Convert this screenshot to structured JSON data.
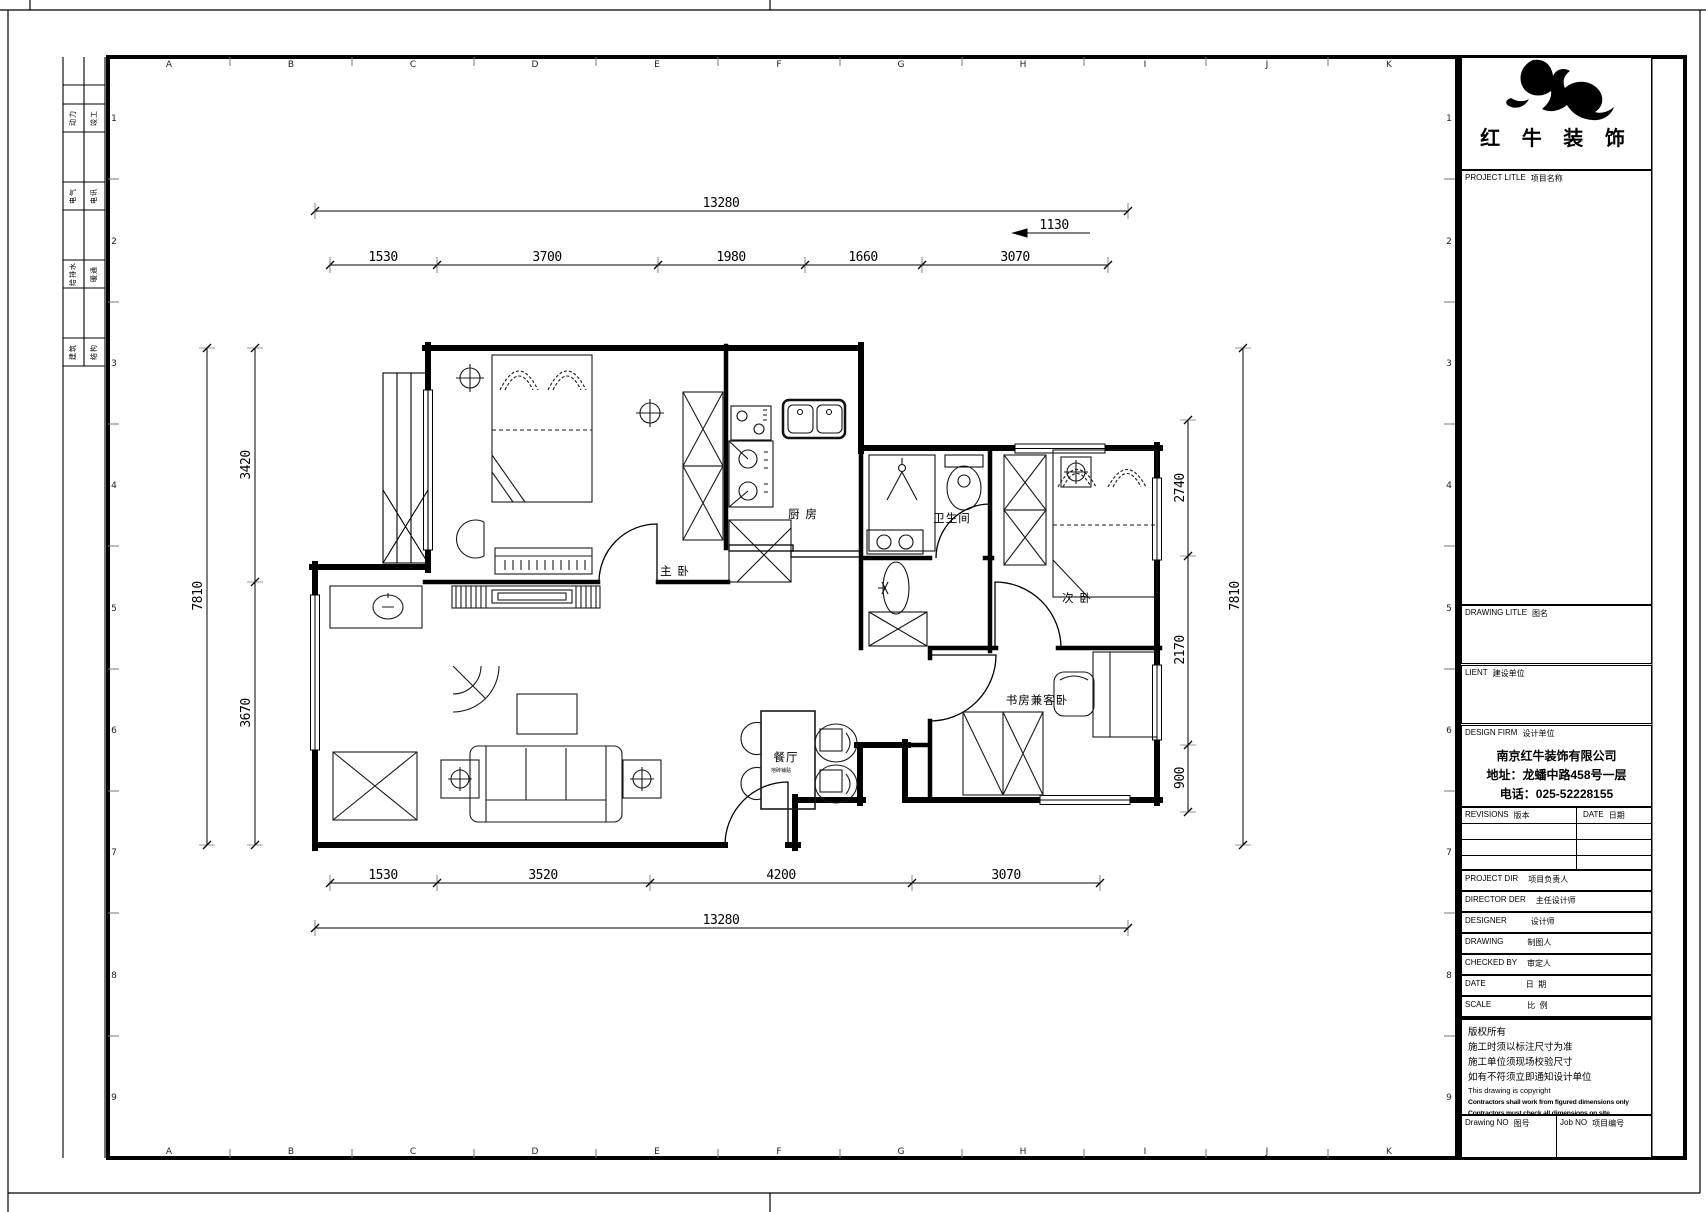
{
  "brand": {
    "name_display": "红 牛 装 饰"
  },
  "margin_strip": {
    "cells": [
      {
        "left": "动力",
        "right": "竣工"
      },
      {
        "left": "电气",
        "right": "电讯"
      },
      {
        "left": "给排水",
        "right": "暖通"
      },
      {
        "left": "建筑",
        "right": "结构"
      }
    ]
  },
  "grid": {
    "letters": [
      "A",
      "B",
      "C",
      "D",
      "E",
      "F",
      "G",
      "H",
      "I",
      "J",
      "K"
    ],
    "numbers": [
      "1",
      "2",
      "3",
      "4",
      "5",
      "6",
      "7",
      "8",
      "9"
    ]
  },
  "floor_plan": {
    "rooms": {
      "master": "主 卧",
      "kitchen": "厨 房",
      "bath": "卫生间",
      "second": "次 卧",
      "study": "书房兼客卧",
      "dining": "餐厅",
      "dining_note": "地砖铺贴"
    },
    "dims": {
      "top_total": "13280",
      "top_offset": "1130",
      "top_segments": [
        "1530",
        "3700",
        "1980",
        "1660",
        "3070"
      ],
      "bottom_segments": [
        "1530",
        "3520",
        "4200",
        "3070"
      ],
      "bottom_total": "13280",
      "left_outer": "7810",
      "left_segments": [
        "3420",
        "3670"
      ],
      "right_segments": [
        "2740",
        "2170",
        "900"
      ],
      "right_outer": "7810"
    }
  },
  "title_block": {
    "project": {
      "en": "PROJECT LITLE",
      "cn": "项目名称"
    },
    "drawing_title": {
      "en": "DRAWING LITLE",
      "cn": "图名"
    },
    "client": {
      "en": "LIENT",
      "cn": "建设单位"
    },
    "firm": {
      "en": "DESIGN FIRM",
      "cn": "设计单位"
    },
    "firm_lines": [
      "南京红牛装饰有限公司",
      "地址：龙蟠中路458号一层",
      "电话：025-52228155"
    ],
    "revisions": {
      "en": "REVISIONS",
      "cn": "版本"
    },
    "rev_date": {
      "en": "DATE",
      "cn": "日期"
    },
    "rows": [
      {
        "en": "PROJECT DIR",
        "cn": "项目负责人"
      },
      {
        "en": "DIRECTOR DER",
        "cn": "主任设计师"
      },
      {
        "en": "DESIGNER",
        "cn": "设计师"
      },
      {
        "en": "DRAWING",
        "cn": "制图人"
      },
      {
        "en": "CHECKED BY",
        "cn": "审定人"
      },
      {
        "en": "DATE",
        "cn": "日  期"
      },
      {
        "en": "SCALE",
        "cn": "比  例"
      }
    ],
    "copyright_lines_cn": [
      "版权所有",
      "施工时须以标注尺寸为准",
      "施工单位须现场校验尺寸",
      "如有不符须立即通知设计单位"
    ],
    "copyright_en": "This drawing is copyright",
    "copyright_lines_en_bold": [
      "Contractors shall work from figured dimensions only",
      "Contractors must check all dimensions on site",
      "Contractors must be reported immediately to architects"
    ],
    "drawing_no": {
      "en": "Drawing NO",
      "cn": "图号"
    },
    "job_no": {
      "en": "Job NO",
      "cn": "项目编号"
    }
  }
}
